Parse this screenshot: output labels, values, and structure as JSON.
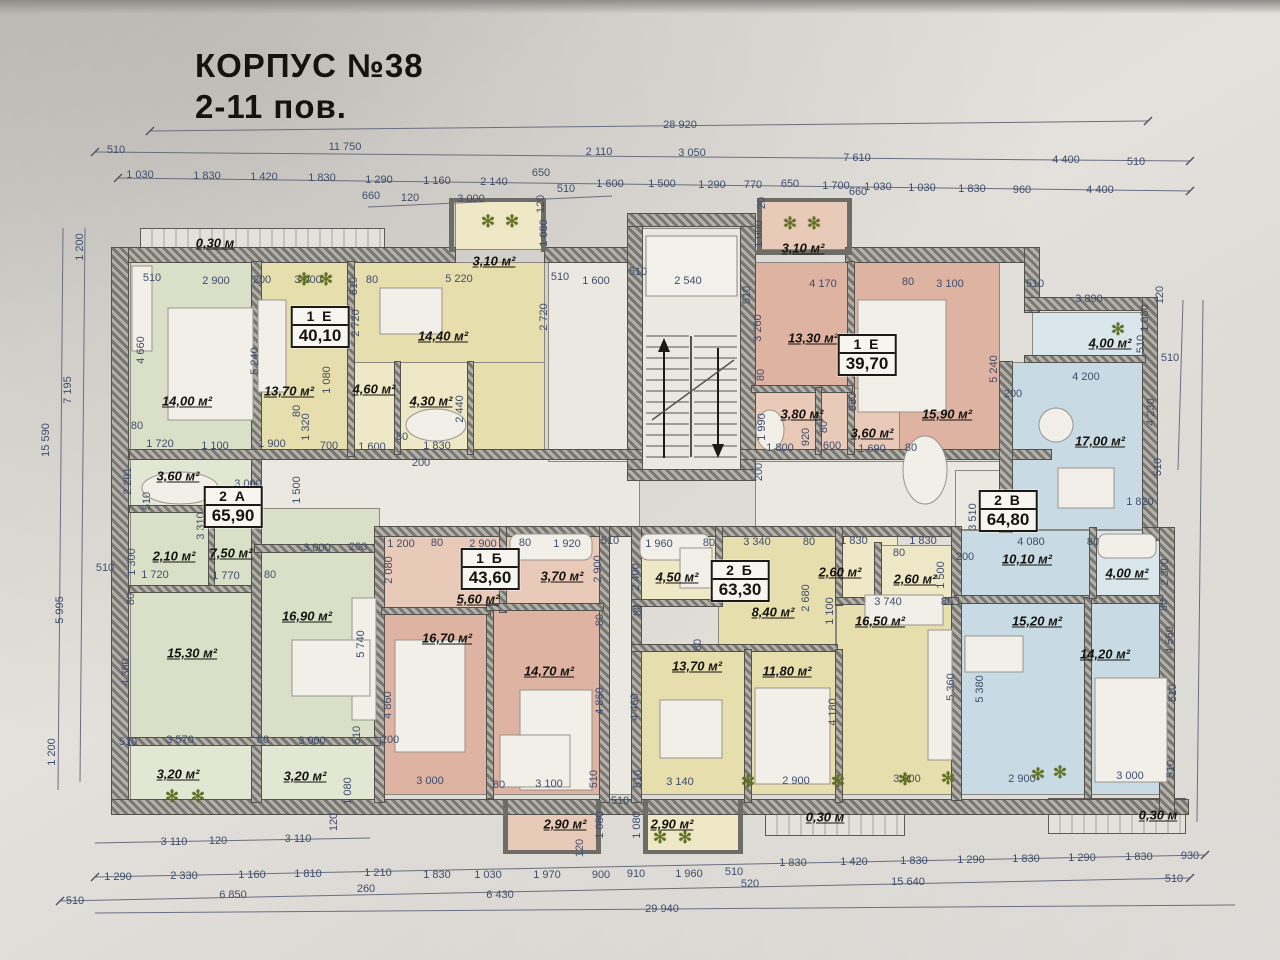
{
  "title": {
    "line1": "КОРПУС №38",
    "line2": "2-11  пов."
  },
  "colors": {
    "green": "#d9e0c7",
    "green_l": "#e2e7d3",
    "yellow": "#e7deae",
    "yellow_l": "#efe8c6",
    "pink": "#deb3a1",
    "pink_l": "#e9c9b8",
    "blue": "#c8dbe4",
    "blue_l": "#d9e7ec",
    "floor": "#eae8e1",
    "rail": "#e0ded6",
    "wall": "#78766f",
    "dim_text": "#3f4d6b"
  },
  "apartments": [
    {
      "id": "1 Е",
      "area": "40,10",
      "x": 320,
      "y": 327
    },
    {
      "id": "1 Е",
      "area": "39,70",
      "x": 867,
      "y": 355
    },
    {
      "id": "2 А",
      "area": "65,90",
      "x": 233,
      "y": 507
    },
    {
      "id": "1 Б",
      "area": "43,60",
      "x": 490,
      "y": 569
    },
    {
      "id": "2 Б",
      "area": "63,30",
      "x": 740,
      "y": 581
    },
    {
      "id": "2 В",
      "area": "64,80",
      "x": 1008,
      "y": 511
    }
  ],
  "rooms": [
    {
      "label": "0,30 м",
      "x": 215,
      "y": 243
    },
    {
      "label": "14,00 м²",
      "x": 187,
      "y": 401
    },
    {
      "label": "13,70 м²",
      "x": 289,
      "y": 391
    },
    {
      "label": "14,40 м²",
      "x": 443,
      "y": 336
    },
    {
      "label": "3,10 м²",
      "x": 494,
      "y": 261
    },
    {
      "label": "4,60 м²",
      "x": 374,
      "y": 389
    },
    {
      "label": "4,30 м²",
      "x": 431,
      "y": 401
    },
    {
      "label": "3,60 м²",
      "x": 178,
      "y": 476
    },
    {
      "label": "2,10 м²",
      "x": 174,
      "y": 556
    },
    {
      "label": "7,50 м²",
      "x": 231,
      "y": 553
    },
    {
      "label": "16,90 м²",
      "x": 307,
      "y": 616
    },
    {
      "label": "15,30 м²",
      "x": 192,
      "y": 653
    },
    {
      "label": "3,20 м²",
      "x": 178,
      "y": 774
    },
    {
      "label": "3,20 м²",
      "x": 305,
      "y": 776
    },
    {
      "label": "5,60 м²",
      "x": 478,
      "y": 599
    },
    {
      "label": "3,70 м²",
      "x": 562,
      "y": 576
    },
    {
      "label": "16,70 м²",
      "x": 447,
      "y": 638
    },
    {
      "label": "14,70 м²",
      "x": 549,
      "y": 671
    },
    {
      "label": "2,90 м²",
      "x": 565,
      "y": 824
    },
    {
      "label": "2,90 м²",
      "x": 672,
      "y": 824
    },
    {
      "label": "4,50 м²",
      "x": 677,
      "y": 577
    },
    {
      "label": "8,40 м²",
      "x": 773,
      "y": 612
    },
    {
      "label": "2,60 м²",
      "x": 840,
      "y": 572
    },
    {
      "label": "2,60 м²",
      "x": 915,
      "y": 579
    },
    {
      "label": "13,70 м²",
      "x": 697,
      "y": 666
    },
    {
      "label": "11,80 м²",
      "x": 787,
      "y": 671
    },
    {
      "label": "16,50 м²",
      "x": 880,
      "y": 621
    },
    {
      "label": "0,30 м",
      "x": 825,
      "y": 817
    },
    {
      "label": "3,10 м²",
      "x": 803,
      "y": 248
    },
    {
      "label": "13,30 м²",
      "x": 813,
      "y": 338
    },
    {
      "label": "3,80 м²",
      "x": 802,
      "y": 414
    },
    {
      "label": "3,60 м²",
      "x": 872,
      "y": 433
    },
    {
      "label": "15,90 м²",
      "x": 947,
      "y": 414
    },
    {
      "label": "4,00 м²",
      "x": 1110,
      "y": 343
    },
    {
      "label": "17,00 м²",
      "x": 1100,
      "y": 441
    },
    {
      "label": "10,10 м²",
      "x": 1027,
      "y": 559
    },
    {
      "label": "4,00 м²",
      "x": 1127,
      "y": 573
    },
    {
      "label": "15,20 м²",
      "x": 1037,
      "y": 621
    },
    {
      "label": "14,20 м²",
      "x": 1105,
      "y": 654
    },
    {
      "label": "0,30 м",
      "x": 1158,
      "y": 815
    }
  ],
  "dims": [
    {
      "t": "28 920",
      "x": 680,
      "y": 125
    },
    {
      "t": "510",
      "x": 116,
      "y": 150
    },
    {
      "t": "11 750",
      "x": 345,
      "y": 147
    },
    {
      "t": "2 110",
      "x": 599,
      "y": 152
    },
    {
      "t": "3 050",
      "x": 692,
      "y": 153
    },
    {
      "t": "7 610",
      "x": 857,
      "y": 158
    },
    {
      "t": "4 400",
      "x": 1066,
      "y": 160
    },
    {
      "t": "510",
      "x": 1136,
      "y": 162
    },
    {
      "t": "1 030",
      "x": 140,
      "y": 175
    },
    {
      "t": "1 830",
      "x": 207,
      "y": 176
    },
    {
      "t": "1 420",
      "x": 264,
      "y": 177
    },
    {
      "t": "1 830",
      "x": 322,
      "y": 178
    },
    {
      "t": "1 290",
      "x": 379,
      "y": 180
    },
    {
      "t": "1 160",
      "x": 437,
      "y": 181
    },
    {
      "t": "2 140",
      "x": 494,
      "y": 182
    },
    {
      "t": "650",
      "x": 541,
      "y": 173
    },
    {
      "t": "1 600",
      "x": 610,
      "y": 184
    },
    {
      "t": "1 500",
      "x": 662,
      "y": 184
    },
    {
      "t": "1 290",
      "x": 712,
      "y": 185
    },
    {
      "t": "770",
      "x": 753,
      "y": 185
    },
    {
      "t": "650",
      "x": 790,
      "y": 184
    },
    {
      "t": "1 700",
      "x": 836,
      "y": 186
    },
    {
      "t": "1 030",
      "x": 878,
      "y": 187
    },
    {
      "t": "1 030",
      "x": 922,
      "y": 188
    },
    {
      "t": "1 830",
      "x": 972,
      "y": 189
    },
    {
      "t": "960",
      "x": 1022,
      "y": 190
    },
    {
      "t": "4 400",
      "x": 1100,
      "y": 190
    },
    {
      "t": "660",
      "x": 371,
      "y": 196
    },
    {
      "t": "120",
      "x": 410,
      "y": 198
    },
    {
      "t": "3 000",
      "x": 471,
      "y": 199
    },
    {
      "t": "120",
      "x": 541,
      "y": 204,
      "v": 1
    },
    {
      "t": "510",
      "x": 566,
      "y": 189
    },
    {
      "t": "20",
      "x": 762,
      "y": 203,
      "v": 1
    },
    {
      "t": "660",
      "x": 858,
      "y": 192
    },
    {
      "t": "510",
      "x": 152,
      "y": 278
    },
    {
      "t": "2 900",
      "x": 216,
      "y": 281
    },
    {
      "t": "200",
      "x": 262,
      "y": 280
    },
    {
      "t": "3 000",
      "x": 308,
      "y": 280
    },
    {
      "t": "510",
      "x": 354,
      "y": 286,
      "v": 1
    },
    {
      "t": "80",
      "x": 372,
      "y": 280
    },
    {
      "t": "5 220",
      "x": 459,
      "y": 279
    },
    {
      "t": "510",
      "x": 560,
      "y": 277
    },
    {
      "t": "1 080",
      "x": 544,
      "y": 233,
      "v": 1
    },
    {
      "t": "2 720",
      "x": 544,
      "y": 317,
      "v": 1
    },
    {
      "t": "4 660",
      "x": 141,
      "y": 350,
      "v": 1
    },
    {
      "t": "5 240",
      "x": 255,
      "y": 361,
      "v": 1
    },
    {
      "t": "2 720",
      "x": 356,
      "y": 323,
      "v": 1
    },
    {
      "t": "1 080",
      "x": 327,
      "y": 380,
      "v": 1
    },
    {
      "t": "1 600",
      "x": 596,
      "y": 281
    },
    {
      "t": "510",
      "x": 638,
      "y": 272
    },
    {
      "t": "2 540",
      "x": 688,
      "y": 281
    },
    {
      "t": "510",
      "x": 747,
      "y": 295,
      "v": 1
    },
    {
      "t": "4 170",
      "x": 823,
      "y": 284
    },
    {
      "t": "1 080",
      "x": 759,
      "y": 234,
      "v": 1
    },
    {
      "t": "80",
      "x": 908,
      "y": 282
    },
    {
      "t": "3 100",
      "x": 950,
      "y": 284
    },
    {
      "t": "510",
      "x": 1035,
      "y": 284
    },
    {
      "t": "3 890",
      "x": 1089,
      "y": 299
    },
    {
      "t": "120",
      "x": 1160,
      "y": 295,
      "v": 1
    },
    {
      "t": "1 080",
      "x": 1145,
      "y": 318,
      "v": 1
    },
    {
      "t": "510",
      "x": 1141,
      "y": 344,
      "v": 1
    },
    {
      "t": "510",
      "x": 1170,
      "y": 358
    },
    {
      "t": "3 260",
      "x": 758,
      "y": 328,
      "v": 1
    },
    {
      "t": "80",
      "x": 761,
      "y": 375,
      "v": 1
    },
    {
      "t": "5 240",
      "x": 994,
      "y": 369,
      "v": 1
    },
    {
      "t": "200",
      "x": 1013,
      "y": 394
    },
    {
      "t": "4 200",
      "x": 1086,
      "y": 377
    },
    {
      "t": "4 230",
      "x": 1151,
      "y": 412,
      "v": 1
    },
    {
      "t": "510",
      "x": 1158,
      "y": 467,
      "v": 1
    },
    {
      "t": "80",
      "x": 137,
      "y": 426
    },
    {
      "t": "1 720",
      "x": 160,
      "y": 444
    },
    {
      "t": "1 100",
      "x": 215,
      "y": 446
    },
    {
      "t": "1 900",
      "x": 272,
      "y": 444
    },
    {
      "t": "80",
      "x": 297,
      "y": 411,
      "v": 1
    },
    {
      "t": "1 320",
      "x": 306,
      "y": 427,
      "v": 1
    },
    {
      "t": "700",
      "x": 329,
      "y": 446
    },
    {
      "t": "1 600",
      "x": 372,
      "y": 447
    },
    {
      "t": "80",
      "x": 402,
      "y": 437
    },
    {
      "t": "1 830",
      "x": 437,
      "y": 446
    },
    {
      "t": "2 440",
      "x": 460,
      "y": 409,
      "v": 1
    },
    {
      "t": "200",
      "x": 421,
      "y": 463
    },
    {
      "t": "1 990",
      "x": 762,
      "y": 427,
      "v": 1
    },
    {
      "t": "980",
      "x": 853,
      "y": 402,
      "v": 1
    },
    {
      "t": "920",
      "x": 806,
      "y": 437,
      "v": 1
    },
    {
      "t": "80",
      "x": 824,
      "y": 427,
      "v": 1
    },
    {
      "t": "600",
      "x": 832,
      "y": 446
    },
    {
      "t": "1 800",
      "x": 780,
      "y": 448
    },
    {
      "t": "1 690",
      "x": 872,
      "y": 449
    },
    {
      "t": "80",
      "x": 911,
      "y": 448
    },
    {
      "t": "200",
      "x": 759,
      "y": 472,
      "v": 1
    },
    {
      "t": "2 201",
      "x": 128,
      "y": 481,
      "v": 1
    },
    {
      "t": "510",
      "x": 147,
      "y": 501,
      "v": 1
    },
    {
      "t": "3 000",
      "x": 248,
      "y": 484
    },
    {
      "t": "1 500",
      "x": 297,
      "y": 490,
      "v": 1
    },
    {
      "t": "3 310",
      "x": 201,
      "y": 526,
      "v": 1
    },
    {
      "t": "1 300",
      "x": 132,
      "y": 562,
      "v": 1
    },
    {
      "t": "510",
      "x": 105,
      "y": 568
    },
    {
      "t": "1 720",
      "x": 155,
      "y": 575
    },
    {
      "t": "1 770",
      "x": 226,
      "y": 576
    },
    {
      "t": "80",
      "x": 270,
      "y": 575
    },
    {
      "t": "80",
      "x": 131,
      "y": 599,
      "v": 1
    },
    {
      "t": "3 000",
      "x": 317,
      "y": 548
    },
    {
      "t": "200",
      "x": 358,
      "y": 547
    },
    {
      "t": "2 080",
      "x": 389,
      "y": 570,
      "v": 1
    },
    {
      "t": "5 740",
      "x": 361,
      "y": 644,
      "v": 1
    },
    {
      "t": "1 200",
      "x": 401,
      "y": 544
    },
    {
      "t": "80",
      "x": 437,
      "y": 543
    },
    {
      "t": "2 900",
      "x": 483,
      "y": 544
    },
    {
      "t": "80",
      "x": 525,
      "y": 543
    },
    {
      "t": "1 920",
      "x": 567,
      "y": 544
    },
    {
      "t": "510",
      "x": 610,
      "y": 541
    },
    {
      "t": "2 900",
      "x": 598,
      "y": 569,
      "v": 1
    },
    {
      "t": "80",
      "x": 600,
      "y": 620,
      "v": 1
    },
    {
      "t": "1 960",
      "x": 659,
      "y": 544
    },
    {
      "t": "80",
      "x": 709,
      "y": 543
    },
    {
      "t": "3 340",
      "x": 757,
      "y": 542
    },
    {
      "t": "80",
      "x": 809,
      "y": 542
    },
    {
      "t": "1 830",
      "x": 854,
      "y": 541
    },
    {
      "t": "1 830",
      "x": 923,
      "y": 541
    },
    {
      "t": "80",
      "x": 899,
      "y": 553
    },
    {
      "t": "1 500",
      "x": 941,
      "y": 575,
      "v": 1
    },
    {
      "t": "2 400",
      "x": 636,
      "y": 577,
      "v": 1
    },
    {
      "t": "80",
      "x": 638,
      "y": 610,
      "v": 1
    },
    {
      "t": "2 680",
      "x": 806,
      "y": 598,
      "v": 1
    },
    {
      "t": "1 100",
      "x": 830,
      "y": 611,
      "v": 1
    },
    {
      "t": "3 740",
      "x": 888,
      "y": 602
    },
    {
      "t": "80",
      "x": 947,
      "y": 602
    },
    {
      "t": "80",
      "x": 698,
      "y": 645,
      "v": 1
    },
    {
      "t": "3 510",
      "x": 973,
      "y": 517,
      "v": 1
    },
    {
      "t": "4 080",
      "x": 1031,
      "y": 542
    },
    {
      "t": "80",
      "x": 1093,
      "y": 542
    },
    {
      "t": "1 820",
      "x": 1140,
      "y": 502
    },
    {
      "t": "2 300",
      "x": 1165,
      "y": 572,
      "v": 1
    },
    {
      "t": "80",
      "x": 1164,
      "y": 605,
      "v": 1
    },
    {
      "t": "200",
      "x": 965,
      "y": 557
    },
    {
      "t": "4 460",
      "x": 635,
      "y": 707,
      "v": 1
    },
    {
      "t": "4 180",
      "x": 833,
      "y": 712,
      "v": 1
    },
    {
      "t": "5 360",
      "x": 951,
      "y": 687,
      "v": 1
    },
    {
      "t": "5 380",
      "x": 980,
      "y": 689,
      "v": 1
    },
    {
      "t": "4 560",
      "x": 1170,
      "y": 640,
      "v": 1
    },
    {
      "t": "510",
      "x": 1173,
      "y": 693,
      "v": 1
    },
    {
      "t": "4 380",
      "x": 126,
      "y": 672,
      "v": 1
    },
    {
      "t": "510",
      "x": 128,
      "y": 742
    },
    {
      "t": "3 570",
      "x": 180,
      "y": 740
    },
    {
      "t": "80",
      "x": 263,
      "y": 740
    },
    {
      "t": "3 000",
      "x": 312,
      "y": 741
    },
    {
      "t": "510",
      "x": 357,
      "y": 735,
      "v": 1
    },
    {
      "t": "200",
      "x": 390,
      "y": 740
    },
    {
      "t": "1 080",
      "x": 348,
      "y": 791,
      "v": 1
    },
    {
      "t": "120",
      "x": 334,
      "y": 822,
      "v": 1
    },
    {
      "t": "4 860",
      "x": 388,
      "y": 705,
      "v": 1
    },
    {
      "t": "4 860",
      "x": 600,
      "y": 701,
      "v": 1
    },
    {
      "t": "3 000",
      "x": 430,
      "y": 781
    },
    {
      "t": "80",
      "x": 499,
      "y": 785
    },
    {
      "t": "3 100",
      "x": 549,
      "y": 784
    },
    {
      "t": "510",
      "x": 594,
      "y": 779,
      "v": 1
    },
    {
      "t": "510",
      "x": 638,
      "y": 779,
      "v": 1
    },
    {
      "t": "510",
      "x": 620,
      "y": 801
    },
    {
      "t": "1 080",
      "x": 600,
      "y": 825,
      "v": 1
    },
    {
      "t": "1 080",
      "x": 637,
      "y": 825,
      "v": 1
    },
    {
      "t": "120",
      "x": 580,
      "y": 848,
      "v": 1
    },
    {
      "t": "3 140",
      "x": 680,
      "y": 782
    },
    {
      "t": "2 900",
      "x": 796,
      "y": 781
    },
    {
      "t": "3 000",
      "x": 907,
      "y": 779
    },
    {
      "t": "2 900",
      "x": 1022,
      "y": 779
    },
    {
      "t": "3 000",
      "x": 1130,
      "y": 776
    },
    {
      "t": "510",
      "x": 1171,
      "y": 769,
      "v": 1
    },
    {
      "t": "3 110",
      "x": 174,
      "y": 842
    },
    {
      "t": "120",
      "x": 218,
      "y": 841
    },
    {
      "t": "3 110",
      "x": 298,
      "y": 839
    },
    {
      "t": "1 290",
      "x": 118,
      "y": 877
    },
    {
      "t": "2 330",
      "x": 184,
      "y": 876
    },
    {
      "t": "1 160",
      "x": 252,
      "y": 875
    },
    {
      "t": "1 810",
      "x": 308,
      "y": 874
    },
    {
      "t": "1 210",
      "x": 378,
      "y": 873
    },
    {
      "t": "1 830",
      "x": 437,
      "y": 875
    },
    {
      "t": "1 030",
      "x": 488,
      "y": 875
    },
    {
      "t": "1 970",
      "x": 547,
      "y": 875
    },
    {
      "t": "900",
      "x": 601,
      "y": 875
    },
    {
      "t": "910",
      "x": 636,
      "y": 874
    },
    {
      "t": "1 960",
      "x": 689,
      "y": 874
    },
    {
      "t": "510",
      "x": 734,
      "y": 872
    },
    {
      "t": "1 830",
      "x": 793,
      "y": 863
    },
    {
      "t": "1 420",
      "x": 854,
      "y": 862
    },
    {
      "t": "1 830",
      "x": 914,
      "y": 861
    },
    {
      "t": "1 290",
      "x": 971,
      "y": 860
    },
    {
      "t": "1 830",
      "x": 1026,
      "y": 859
    },
    {
      "t": "1 290",
      "x": 1082,
      "y": 858
    },
    {
      "t": "1 830",
      "x": 1139,
      "y": 857
    },
    {
      "t": "930",
      "x": 1190,
      "y": 856
    },
    {
      "t": "510",
      "x": 75,
      "y": 901
    },
    {
      "t": "6 850",
      "x": 233,
      "y": 895
    },
    {
      "t": "260",
      "x": 366,
      "y": 889
    },
    {
      "t": "6 430",
      "x": 500,
      "y": 895
    },
    {
      "t": "520",
      "x": 750,
      "y": 884
    },
    {
      "t": "15 640",
      "x": 908,
      "y": 882
    },
    {
      "t": "510",
      "x": 1174,
      "y": 879
    },
    {
      "t": "29 940",
      "x": 662,
      "y": 909
    },
    {
      "t": "1 200",
      "x": 80,
      "y": 247,
      "v": 1
    },
    {
      "t": "7 195",
      "x": 68,
      "y": 390,
      "v": 1
    },
    {
      "t": "15 590",
      "x": 46,
      "y": 440,
      "v": 1
    },
    {
      "t": "5 995",
      "x": 60,
      "y": 610,
      "v": 1
    },
    {
      "t": "1 200",
      "x": 52,
      "y": 752,
      "v": 1
    }
  ],
  "plants": [
    {
      "x": 304,
      "y": 280
    },
    {
      "x": 326,
      "y": 280
    },
    {
      "x": 488,
      "y": 222
    },
    {
      "x": 512,
      "y": 222
    },
    {
      "x": 790,
      "y": 224
    },
    {
      "x": 814,
      "y": 224
    },
    {
      "x": 1118,
      "y": 330
    },
    {
      "x": 172,
      "y": 797
    },
    {
      "x": 198,
      "y": 797
    },
    {
      "x": 660,
      "y": 838
    },
    {
      "x": 685,
      "y": 838
    },
    {
      "x": 748,
      "y": 782
    },
    {
      "x": 838,
      "y": 782
    },
    {
      "x": 905,
      "y": 780
    },
    {
      "x": 948,
      "y": 779
    },
    {
      "x": 1038,
      "y": 775
    },
    {
      "x": 1060,
      "y": 773
    }
  ]
}
